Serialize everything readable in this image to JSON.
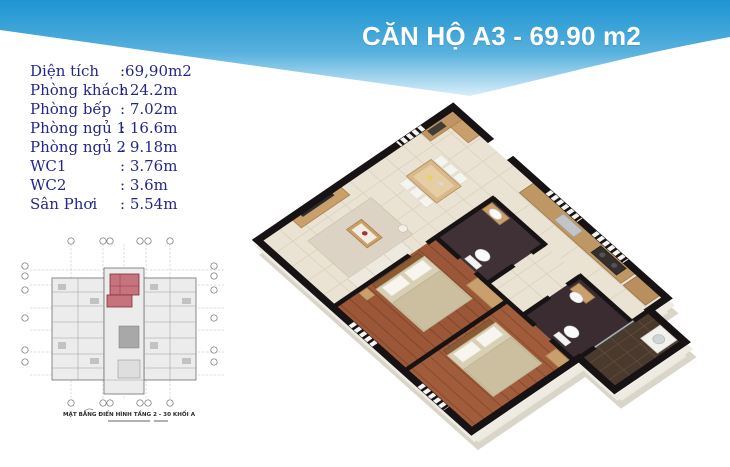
{
  "banner": {
    "title": "CĂN HỘ A3 - 69.90 m2",
    "gradient_top": "#1d94d2",
    "gradient_bottom": "#d9eef9"
  },
  "specs": {
    "text_color": "#23278b",
    "items": [
      {
        "label": "Diện tích",
        "value": ":69,90m2"
      },
      {
        "label": "Phòng khách",
        "value": ": 24.2m"
      },
      {
        "label": "Phòng bếp",
        "value": ": 7.02m"
      },
      {
        "label": "Phòng ngủ 1",
        "value": ": 16.6m"
      },
      {
        "label": "Phòng ngủ 2",
        "value": ": 9.18m"
      },
      {
        "label": "WC1",
        "value": ": 3.76m"
      },
      {
        "label": "WC2",
        "value": ": 3.6m"
      },
      {
        "label": "Sân Phơi",
        "value": ": 5.54m"
      }
    ]
  },
  "site_plan": {
    "caption": "MẶT BẰNG ĐIỂN HÌNH TẦNG 2 - 30 KHỐI A",
    "highlight_color": "#c7737e"
  },
  "floor_plan_3d": {
    "rooms": [
      "Phòng khách",
      "Phòng bếp",
      "Phòng ngủ 1",
      "Phòng ngủ 2",
      "WC1",
      "WC2",
      "Sân Phơi"
    ],
    "colors": {
      "tile_floor": "#eae2d2",
      "wood_floor": "#9b5737",
      "wc_floor": "#3f3136",
      "balcony_floor": "#4a392d",
      "walls": "#171214",
      "cabinet_wood": "#c9a06b"
    }
  }
}
